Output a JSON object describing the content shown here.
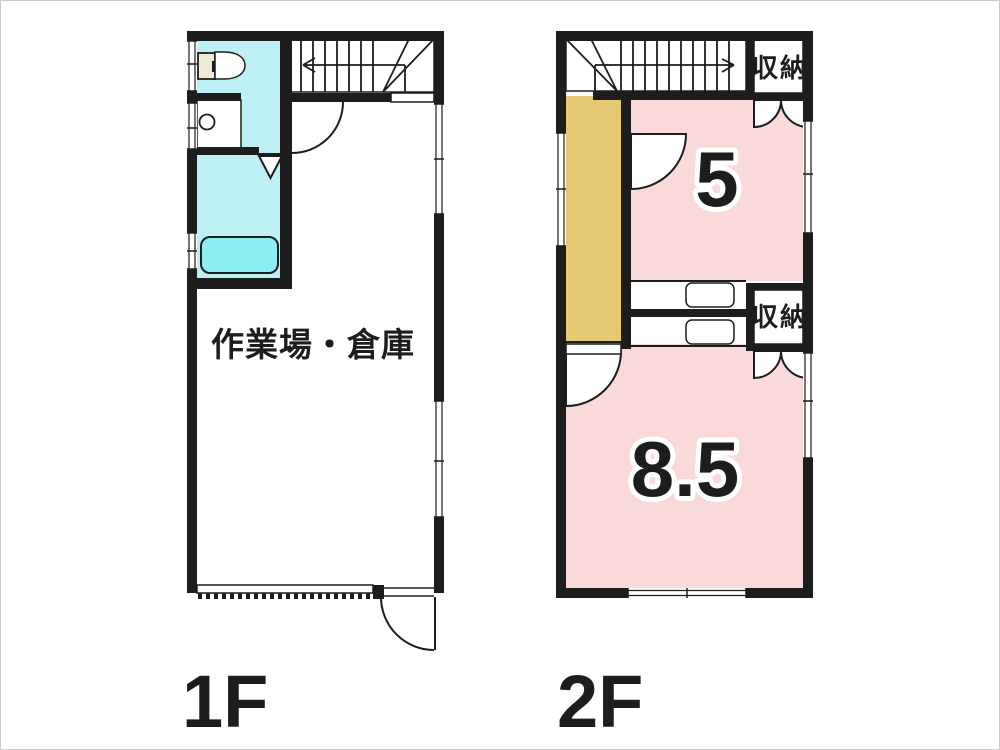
{
  "colors": {
    "wall": "#1d1d1d",
    "pink": "#f9d9da",
    "yellow": "#e4c872",
    "cyan": "#bdf0f4",
    "tub": "#8deef2",
    "cream": "#efead8",
    "frame": "#c9c9c9"
  },
  "floor1": {
    "label": "1F",
    "workshop_label": "作業場・倉庫"
  },
  "floor2": {
    "label": "2F",
    "room5_label": "5",
    "room85_label": "8.5",
    "closet_top_label": "収納",
    "closet_mid_label": "収納"
  }
}
